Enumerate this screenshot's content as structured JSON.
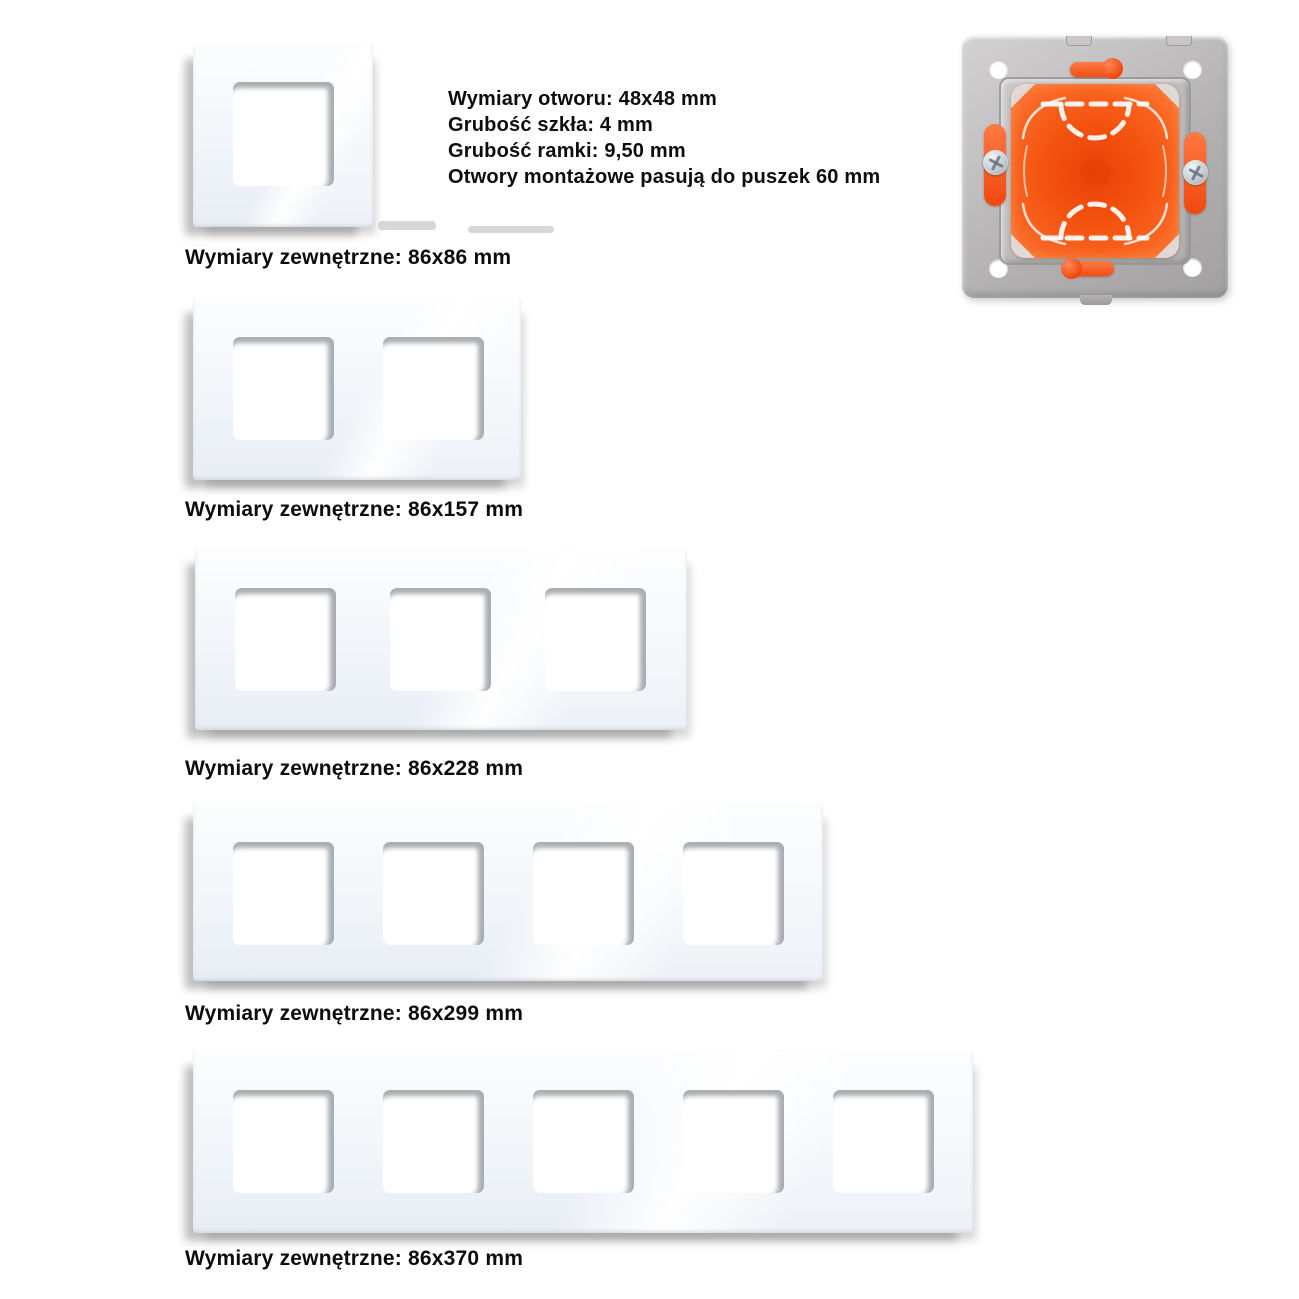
{
  "specs": {
    "lines": [
      "Wymiary otworu: 48x48 mm",
      "Grubość szkła: 4 mm",
      "Grubość ramki: 9,50 mm",
      "Otwory montażowe pasują do puszek 60 mm"
    ]
  },
  "frames": [
    {
      "gangs": 1,
      "label": "Wymiary zewnętrzne: 86x86 mm"
    },
    {
      "gangs": 2,
      "label": "Wymiary zewnętrzne: 86x157 mm"
    },
    {
      "gangs": 3,
      "label": "Wymiary zewnętrzne: 86x228 mm"
    },
    {
      "gangs": 4,
      "label": "Wymiary zewnętrzne: 86x299 mm"
    },
    {
      "gangs": 5,
      "label": "Wymiary zewnętrzne: 86x370 mm"
    }
  ],
  "colors": {
    "glass_tint": "#f2f6fa",
    "opening_shadow": "#a9aeb2",
    "plastic_gray": "#bfbdbe",
    "box_orange": "#f4530f",
    "clip_orange": "#f24d12",
    "screw_silver": "#c5cbd4",
    "hole_white": "#ffffff",
    "text": "#0d0d0d"
  }
}
